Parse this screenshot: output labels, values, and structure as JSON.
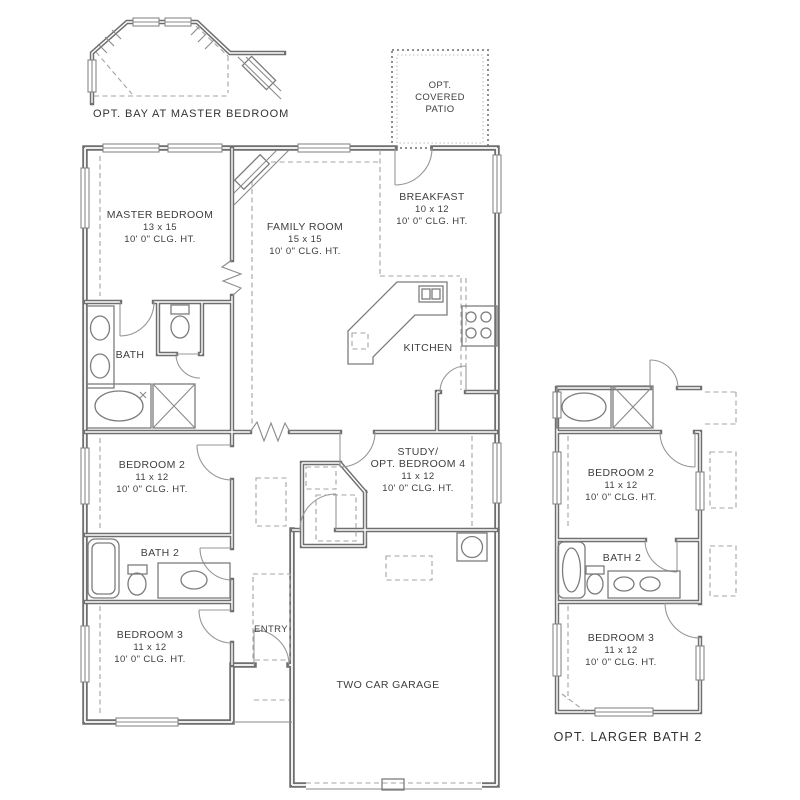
{
  "colors": {
    "wall": "#6f6f6f",
    "thin_line": "#8a8a8a",
    "dashed_line": "#a3a3a3",
    "text": "#3e3e3e",
    "background": "#ffffff"
  },
  "captions": {
    "opt_bay": "OPT. BAY AT MASTER BEDROOM",
    "opt_larger_bath": "OPT. LARGER BATH 2"
  },
  "patio": {
    "l1": "OPT.",
    "l2": "COVERED",
    "l3": "PATIO"
  },
  "rooms": {
    "master": {
      "name": "MASTER BEDROOM",
      "dims": "13 x 15",
      "clg": "10' 0\" CLG. HT."
    },
    "family": {
      "name": "FAMILY ROOM",
      "dims": "15 x 15",
      "clg": "10' 0\" CLG. HT."
    },
    "breakfast": {
      "name": "BREAKFAST",
      "dims": "10 x 12",
      "clg": "10' 0\" CLG. HT."
    },
    "kitchen": {
      "name": "KITCHEN"
    },
    "bath": {
      "name": "BATH"
    },
    "bedroom2": {
      "name": "BEDROOM 2",
      "dims": "11 x 12",
      "clg": "10' 0\" CLG. HT."
    },
    "study": {
      "name1": "STUDY/",
      "name2": "OPT. BEDROOM 4",
      "dims": "11 x 12",
      "clg": "10' 0\" CLG. HT."
    },
    "bath2": {
      "name": "BATH 2"
    },
    "bedroom3": {
      "name": "BEDROOM 3",
      "dims": "11 x 12",
      "clg": "10' 0\" CLG. HT."
    },
    "entry": {
      "name": "ENTRY"
    },
    "garage": {
      "name": "TWO CAR GARAGE"
    }
  },
  "inset": {
    "bedroom2": {
      "name": "BEDROOM 2",
      "dims": "11 x 12",
      "clg": "10' 0\" CLG. HT."
    },
    "bath2": {
      "name": "BATH 2"
    },
    "bedroom3": {
      "name": "BEDROOM 3",
      "dims": "11 x 12",
      "clg": "10' 0\" CLG. HT."
    }
  }
}
